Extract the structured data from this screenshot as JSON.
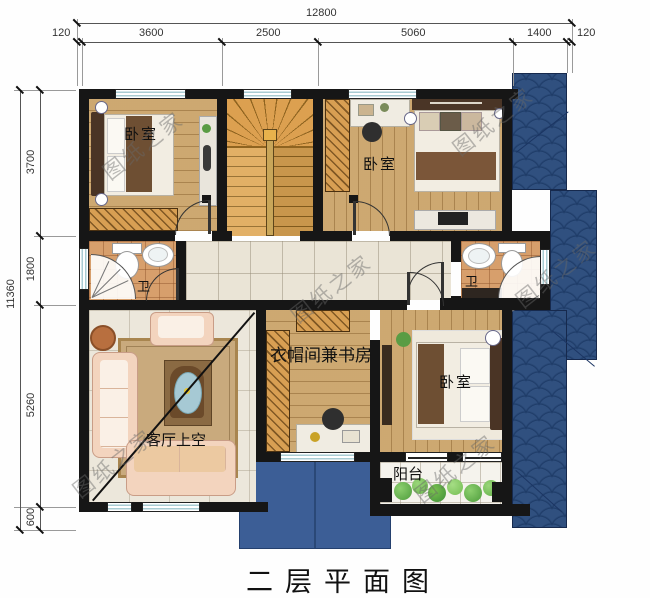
{
  "title": "二层平面图",
  "watermark": {
    "text": "图纸之家"
  },
  "dimensions": {
    "top": {
      "total": "12800",
      "segments": [
        "120",
        "3600",
        "2500",
        "5060",
        "1400",
        "120"
      ]
    },
    "left": {
      "total": "11360",
      "segments": [
        "3700",
        "1800",
        "5260",
        "600"
      ]
    }
  },
  "rooms": {
    "bedroom_top_left": {
      "label": "卧室"
    },
    "bedroom_top_right": {
      "label": "卧室"
    },
    "bedroom_bottom_right": {
      "label": "卧室"
    },
    "bathroom_left": {
      "label": "卫"
    },
    "bathroom_right": {
      "label": "卫"
    },
    "cloakroom_study": {
      "label": "衣帽间兼书房"
    },
    "living_void": {
      "label": "客厅上空"
    },
    "balcony": {
      "label": "阳台"
    }
  },
  "colors": {
    "wall": "#161616",
    "roof_tile": "#30507f",
    "canopy": "#3c5e96",
    "wood_floor": "#c9a266",
    "bath_tile": "#d79f6c",
    "hall_tile": "#eae4d6",
    "stair": "#d6963f"
  }
}
